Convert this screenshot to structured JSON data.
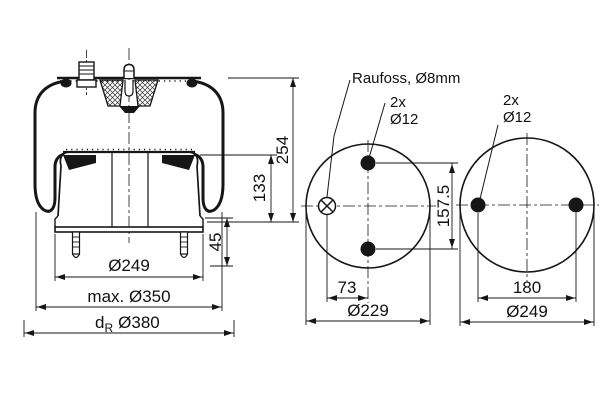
{
  "drawing": {
    "background": "#ffffff",
    "line_color": "#161616",
    "side_view": {
      "dim_height_total": "254",
      "dim_height_piston": "133",
      "dim_height_studs": "45",
      "dim_dia_piston": "Ø249",
      "dim_dia_max": "max. Ø350",
      "dim_dia_rim_base": "d",
      "dim_dia_rim_sub": "R",
      "dim_dia_rim_value": "Ø380"
    },
    "top_view_middle": {
      "port_label": "Raufoss, Ø8mm",
      "holes_count": "2x",
      "holes_dia": "Ø12",
      "dim_hole_spacing_vertical": "157.5",
      "dim_port_offset": "73",
      "dim_outer_dia": "Ø229"
    },
    "top_view_right": {
      "holes_count": "2x",
      "holes_dia": "Ø12",
      "dim_hole_spacing": "180",
      "dim_outer_dia": "Ø249"
    }
  }
}
